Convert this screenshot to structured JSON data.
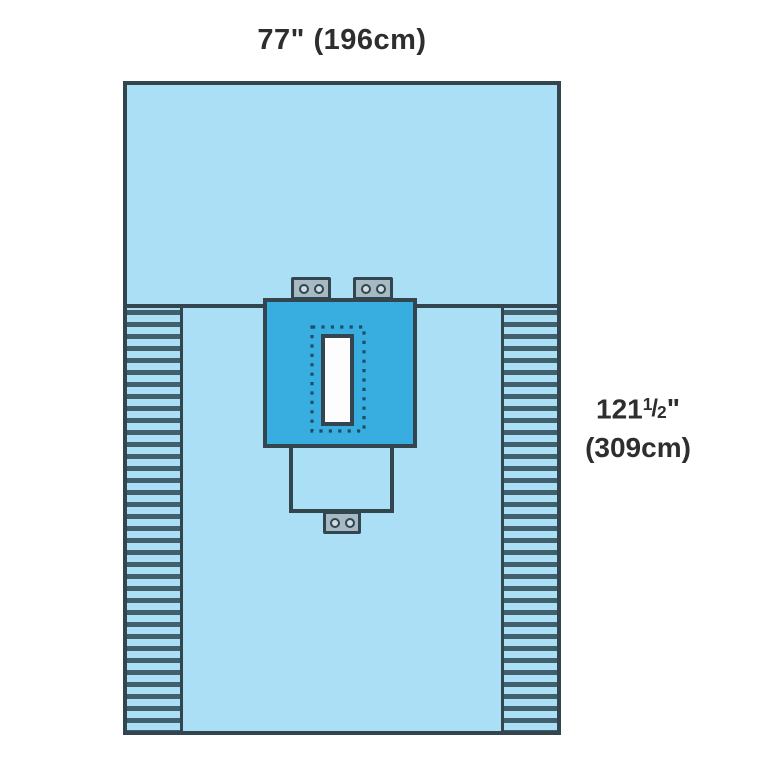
{
  "colors": {
    "canvas-bg": "#ffffff",
    "sheet": "#abdff6",
    "reinforcement": "#38ade0",
    "outline": "#33454f",
    "pleat-stripe": "#41606c",
    "tab-fill": "#a5bac3",
    "tab-hole": "#cfdde2",
    "fenestration": "#fdfdfd",
    "dot": "#1d4e66",
    "label-text": "#2e2e2e"
  },
  "labels": {
    "width": "77\" (196cm)",
    "height": {
      "whole": "121",
      "fraction_numerator": "1",
      "fraction_slash": "/",
      "fraction_denominator": "2",
      "unit_mark": "\"",
      "line2": "(309cm)"
    }
  }
}
